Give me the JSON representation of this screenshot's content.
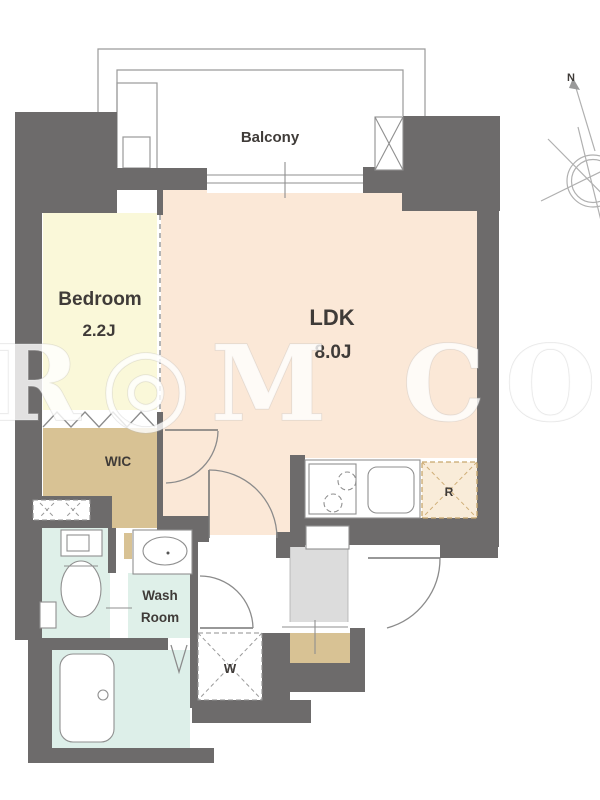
{
  "floorplan": {
    "rooms": {
      "balcony": {
        "label": "Balcony"
      },
      "bedroom": {
        "label": "Bedroom",
        "size": "2.2J"
      },
      "ldk": {
        "label": "LDK",
        "size": "8.0J"
      },
      "wic": {
        "label": "WIC"
      },
      "washroom": {
        "line1": "Wash",
        "line2": "Room"
      }
    },
    "markers": {
      "washing_machine": "W",
      "refrigerator": "R"
    },
    "compass": {
      "north_label": "N"
    },
    "watermark": {
      "text": "R◎M COR"
    },
    "colors": {
      "wall": "#6d6b6b",
      "bedroom_floor": "#faf8d9",
      "ldk_floor": "#fbe8d7",
      "wic_floor": "#d8c294",
      "wet_area_floor": "#dff0e9",
      "bath_floor": "#ddefe9",
      "entry_floor": "#dcdcdc",
      "r_box": "#f9ecd9"
    }
  }
}
